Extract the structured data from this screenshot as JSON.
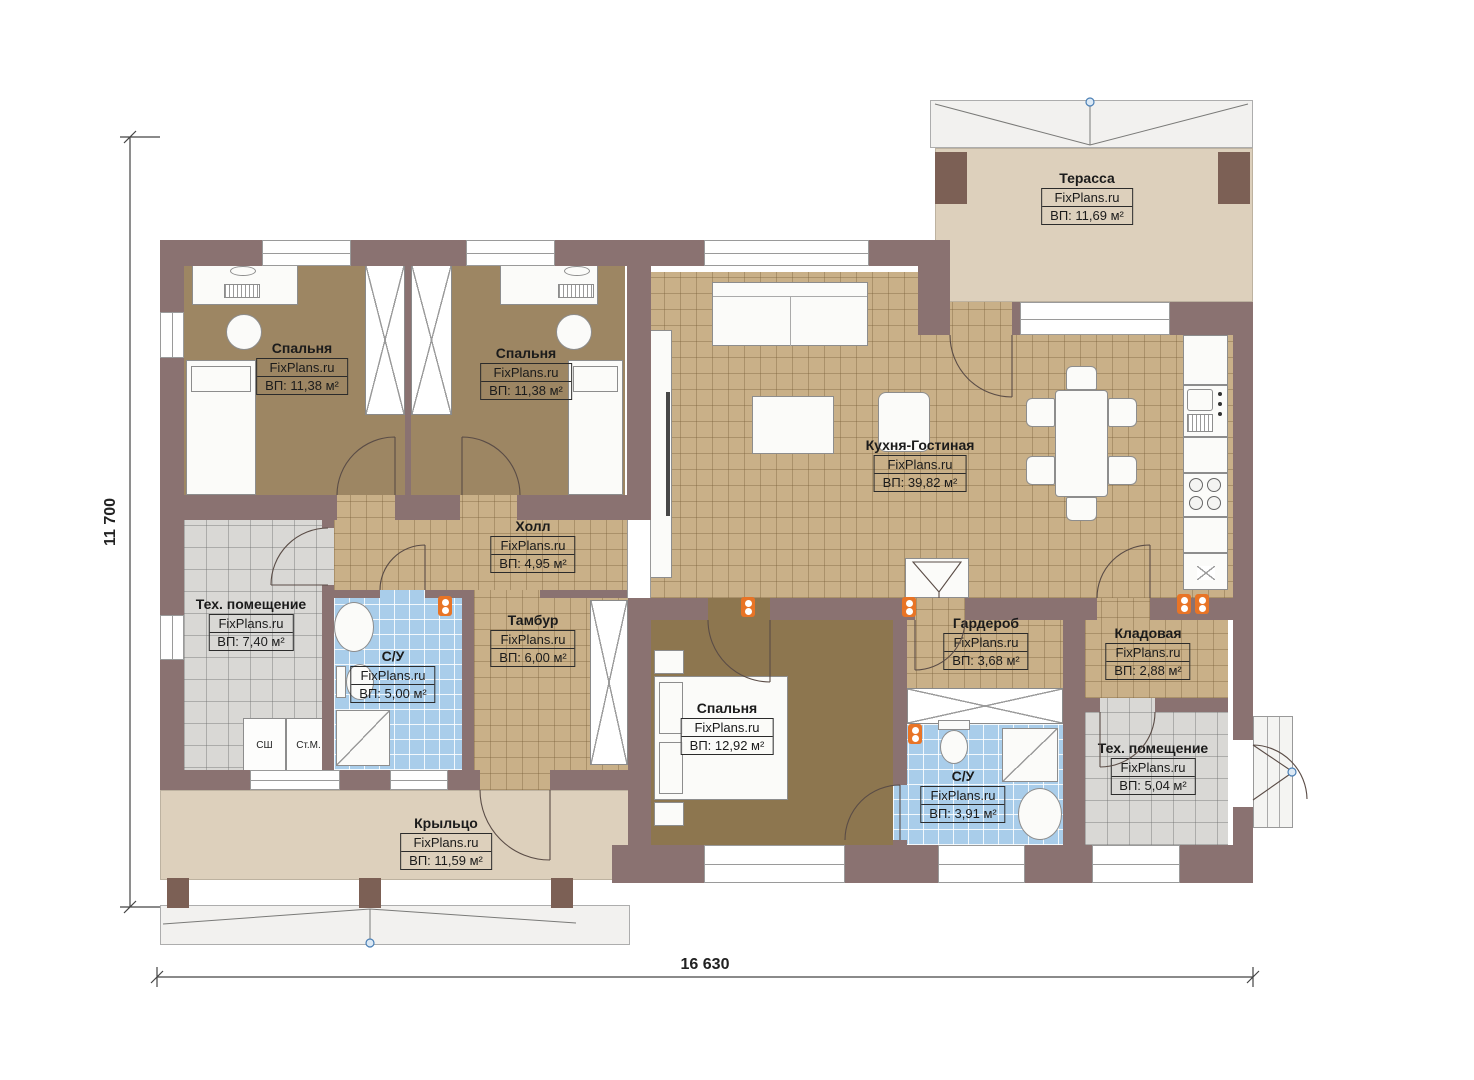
{
  "watermark": "FixPlans.ru",
  "dimensions": {
    "side": "11 700",
    "bottom": "16 630"
  },
  "rooms": [
    {
      "key": "terrace",
      "name": "Терасса",
      "area": "ВП: 11,69 м²"
    },
    {
      "key": "bedroom-1",
      "name": "Спальня",
      "area": "ВП: 11,38 м²"
    },
    {
      "key": "bedroom-2",
      "name": "Спальня",
      "area": "ВП: 11,38 м²"
    },
    {
      "key": "kitchen-living",
      "name": "Кухня-Гостиная",
      "area": "ВП: 39,82 м²"
    },
    {
      "key": "hall",
      "name": "Холл",
      "area": "ВП: 4,95 м²"
    },
    {
      "key": "tech-room-1",
      "name": "Тех. помещение",
      "area": "ВП: 7,40 м²"
    },
    {
      "key": "bathroom-1",
      "name": "С/У",
      "area": "ВП: 5,00 м²"
    },
    {
      "key": "vestibule",
      "name": "Тамбур",
      "area": "ВП: 6,00 м²"
    },
    {
      "key": "bedroom-3",
      "name": "Спальня",
      "area": "ВП: 12,92 м²"
    },
    {
      "key": "wardrobe",
      "name": "Гардероб",
      "area": "ВП: 3,68 м²"
    },
    {
      "key": "storage",
      "name": "Кладовая",
      "area": "ВП: 2,88 м²"
    },
    {
      "key": "bathroom-2",
      "name": "С/У",
      "area": "ВП: 3,91 м²"
    },
    {
      "key": "tech-room-2",
      "name": "Тех. помещение",
      "area": "ВП: 5,04 м²"
    },
    {
      "key": "porch",
      "name": "Крыльцо",
      "area": "ВП: 11,59 м²"
    }
  ],
  "appliances": {
    "dishwasher_label": "СШ",
    "washing_machine_label": "Ст.М."
  },
  "colors": {
    "wall": "#8a7271",
    "pillar": "#7c6055",
    "bedroom_floor": "#9d8663",
    "master_bedroom_floor": "#8d764f",
    "tile_floor": "#c9b088",
    "terrace_floor": "#ddd0bc",
    "bathroom_floor": "#a9cdea",
    "tech_floor": "#d9d8d5",
    "heater": "#e87426",
    "roof_band": "#f2f1ef"
  }
}
